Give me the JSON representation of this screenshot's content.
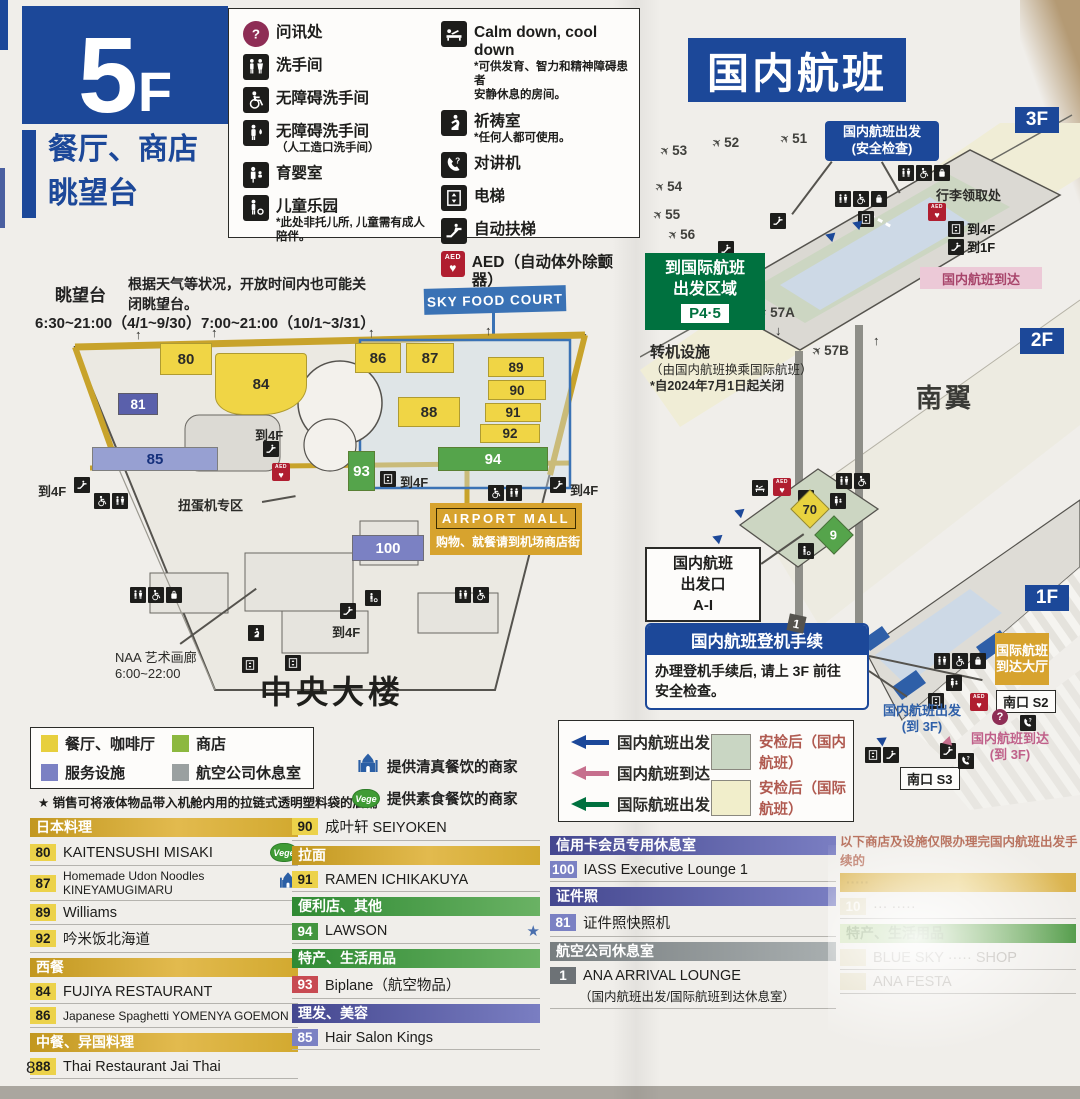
{
  "icons": {
    "question": "?",
    "star": "★",
    "heart": "♥",
    "aed": "AED",
    "vege": "Vege",
    "up": "↑",
    "down": "↓"
  },
  "page_number": "8",
  "left_header": {
    "floor_big": "5",
    "floor_small": "F",
    "subtitle1": "餐厅、商店",
    "subtitle2": "眺望台"
  },
  "domestic_title": "国内航班",
  "facility_legend": {
    "col1": [
      {
        "icon": "info-icon",
        "label": "问讯处"
      },
      {
        "icon": "toilet-icon",
        "label": "洗手间"
      },
      {
        "icon": "wheelchair-icon",
        "label": "无障碍洗手间"
      },
      {
        "icon": "ostomate-icon",
        "label": "无障碍洗手间",
        "note": "（人工造口洗手间）"
      },
      {
        "icon": "nursery-icon",
        "label": "育婴室"
      },
      {
        "icon": "kids-icon",
        "label": "儿童乐园",
        "note": "*此处非托儿所, 儿童需有成人陪伴。"
      }
    ],
    "col2": [
      {
        "icon": "calm-icon",
        "label": "Calm down, cool down",
        "note": "*可供发育、智力和精神障碍患者",
        "note2": "安静休息的房间。"
      },
      {
        "icon": "prayer-icon",
        "label": "祈祷室",
        "note": "*任何人都可使用。"
      },
      {
        "icon": "intercom-icon",
        "label": "对讲机"
      },
      {
        "icon": "elevator-icon",
        "label": "电梯"
      },
      {
        "icon": "escalator-icon",
        "label": "自动扶梯"
      },
      {
        "icon": "aed-icon",
        "label": "AED（自动体外除颤器）"
      }
    ]
  },
  "deck": {
    "title": "眺望台",
    "note_line1": "根据天气等状况，开放时间内也可能关",
    "note_line2": "闭眺望台。",
    "hours": "6:30~21:00（4/1~9/30）7:00~21:00（10/1~3/31）"
  },
  "left_map": {
    "sky_food_court": "SKY FOOD COURT",
    "units": {
      "u80": "80",
      "u81": "81",
      "u84": "84",
      "u85": "85",
      "u86": "86",
      "u87": "87",
      "u88": "88",
      "u89": "89",
      "u90": "90",
      "u91": "91",
      "u92": "92",
      "u93": "93",
      "u94": "94",
      "u100": "100"
    },
    "to_4f": "到4F",
    "gacha_label": "扭蛋机专区",
    "airport_mall_title": "AIRPORT MALL",
    "airport_mall_sub": "购物、就餐请到机场商店街",
    "naa_line1": "NAA 艺术画廊",
    "naa_line2": "6:00~22:00",
    "building_label": "中央大楼"
  },
  "category_legend": {
    "items": [
      {
        "label": "餐厅、咖啡厅",
        "color": "#e7cf3d"
      },
      {
        "label": "商店",
        "color": "#8cb83f"
      },
      {
        "label": "服务设施",
        "color": "#7b81c3"
      },
      {
        "label": "航空公司休息室",
        "color": "#9aa0a0"
      }
    ],
    "halal_note": "提供清真餐饮的商家",
    "vege_note": "提供素食餐饮的商家",
    "star_note": "★ 销售可将液体物品带入机舱内用的拉链式透明塑料袋的店铺"
  },
  "directory": {
    "col1": [
      {
        "type": "header",
        "style": "gold",
        "label": "日本料理"
      },
      {
        "type": "item",
        "chip": "80",
        "chip_style": "yellow",
        "label": "KAITENSUSHI MISAKI",
        "badge": "vege"
      },
      {
        "type": "item",
        "chip": "87",
        "chip_style": "yellow",
        "label": "Homemade Udon Noodles KINEYAMUGIMARU",
        "badge": "halal",
        "small": true
      },
      {
        "type": "item",
        "chip": "89",
        "chip_style": "yellow",
        "label": "Williams"
      },
      {
        "type": "item",
        "chip": "92",
        "chip_style": "yellow",
        "label": "吟米饭北海道"
      },
      {
        "type": "header",
        "style": "gold",
        "label": "西餐"
      },
      {
        "type": "item",
        "chip": "84",
        "chip_style": "yellow",
        "label": "FUJIYA RESTAURANT"
      },
      {
        "type": "item",
        "chip": "86",
        "chip_style": "yellow",
        "label": "Japanese Spaghetti YOMENYA GOEMON",
        "small": true
      },
      {
        "type": "header",
        "style": "gold",
        "label": "中餐、异国料理"
      },
      {
        "type": "item",
        "chip": "88",
        "chip_style": "yellow",
        "label": "Thai Restaurant Jai Thai"
      }
    ],
    "col2": [
      {
        "type": "item",
        "chip": "90",
        "chip_style": "yellow",
        "label": "成叶轩 SEIYOKEN"
      },
      {
        "type": "header",
        "style": "gold",
        "label": "拉面"
      },
      {
        "type": "item",
        "chip": "91",
        "chip_style": "yellow",
        "label": "RAMEN ICHIKAKUYA"
      },
      {
        "type": "header",
        "style": "green",
        "label": "便利店、其他"
      },
      {
        "type": "item",
        "chip": "94",
        "chip_style": "green",
        "label": "LAWSON",
        "badge": "star"
      },
      {
        "type": "header",
        "style": "green",
        "label": "特产、生活用品"
      },
      {
        "type": "item",
        "chip": "93",
        "chip_style": "red",
        "label": "Biplane（航空物品）"
      },
      {
        "type": "header",
        "style": "purple",
        "label": "理发、美容"
      },
      {
        "type": "item",
        "chip": "85",
        "chip_style": "blue",
        "label": "Hair Salon Kings"
      }
    ],
    "col3": [
      {
        "type": "header",
        "style": "purple",
        "label": "信用卡会员专用休息室"
      },
      {
        "type": "item",
        "chip": "100",
        "chip_style": "blue",
        "label": "IASS Executive Lounge 1"
      },
      {
        "type": "header",
        "style": "purple",
        "label": "证件照"
      },
      {
        "type": "item",
        "chip": "81",
        "chip_style": "blue",
        "label": "证件照快照机"
      },
      {
        "type": "header",
        "style": "gray",
        "label": "航空公司休息室"
      },
      {
        "type": "item",
        "chip": "1",
        "chip_style": "dark",
        "label": "ANA ARRIVAL LOUNGE",
        "note": "（国内航班出发/国际航班到达休息室）"
      }
    ],
    "col4_washed": {
      "notice1": "以下商店及设施仅限办理完国内航班出发手续的",
      "notice2": "旅客利用，……送的顾客不得利用。",
      "rows": [
        {
          "type": "header",
          "style": "gold",
          "label": "·····"
        },
        {
          "type": "item",
          "chip": "10",
          "chip_style": "yellow",
          "label": "··· ·····"
        },
        {
          "type": "header",
          "style": "green",
          "label": "特产、生活用品"
        },
        {
          "type": "item",
          "chip": "",
          "chip_style": "green",
          "label": "BLUE SKY ····· SHOP"
        },
        {
          "type": "item",
          "chip": "",
          "chip_style": "green",
          "label": "ANA FESTA"
        }
      ]
    }
  },
  "right_map": {
    "floors": {
      "f3": "3F",
      "f2": "2F",
      "f1": "1F"
    },
    "gates": {
      "g51": "51",
      "g52": "52",
      "g53": "53",
      "g54": "54",
      "g55": "55",
      "g56": "56",
      "g57a": "57A",
      "g57b": "57B"
    },
    "dep_box_line1": "国内航班出发",
    "dep_box_line2": "(安全检查)",
    "baggage_label": "行李领取处",
    "to4f": "到4F",
    "to1f": "到1F",
    "arrival_pink": "国内航班到达",
    "intl_line1": "到国际航班",
    "intl_line2": "出发区域",
    "intl_p45": "P4·5",
    "transfer_line1": "转机设施",
    "transfer_line2": "（由国内航班换乘国际航班）",
    "transfer_line3": "*自2024年7月1日起关闭",
    "south_wing": "南翼",
    "u70": "70",
    "u9": "9",
    "u1": "1",
    "gatebox_line1": "国内航班",
    "gatebox_line2": "出发口",
    "gatebox_line3": "A-I",
    "checkin_title": "国内航班登机手续",
    "checkin_body1": "办理登机手续后, 请上 3F 前往",
    "checkin_body2": "安全检查。",
    "intl_arr_line1": "国际航班",
    "intl_arr_line2": "到达大厅",
    "south_s2": "南口 S2",
    "south_s3": "南口 S3",
    "dep3f_line1": "国内航班出发",
    "dep3f_line2": "(到 3F)",
    "arr3f_line1": "国内航班到达",
    "arr3f_line2": "(到 3F)"
  },
  "flow_legend": {
    "rows": [
      {
        "arrow": "#1c4899",
        "label": "国内航班出发"
      },
      {
        "arrow": "#c66f8d",
        "label": "国内航班到达"
      },
      {
        "arrow": "#00713f",
        "label": "国际航班出发"
      }
    ],
    "zones": [
      {
        "color": "#c9d6c3",
        "label": "安检后（国内航班）"
      },
      {
        "color": "#f1eecb",
        "label": "安检后（国际航班）"
      }
    ]
  }
}
